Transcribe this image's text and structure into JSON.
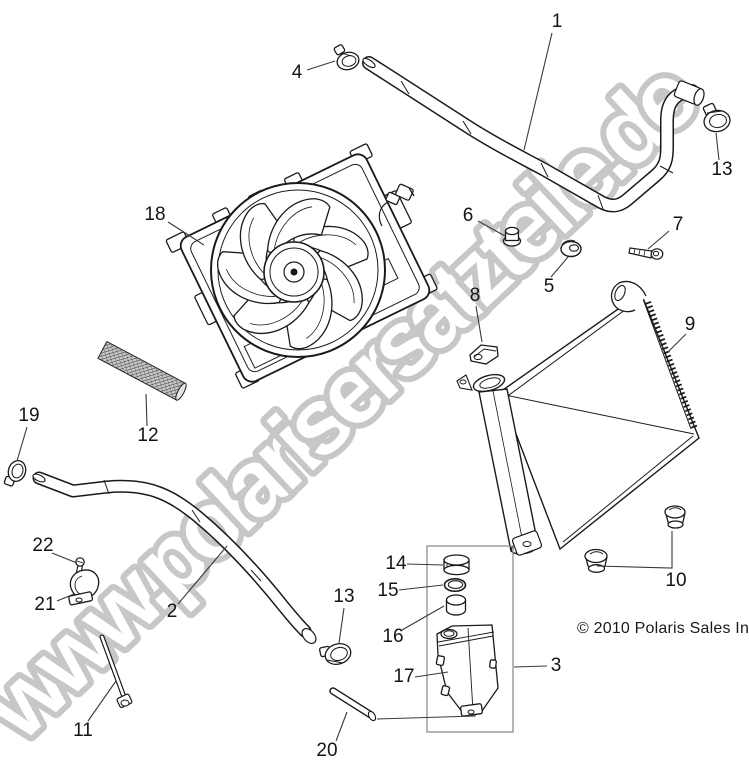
{
  "watermark": {
    "text": "www.polarisersatzteile.de",
    "fill": "#ffffff",
    "stroke": "#c7c7c7"
  },
  "copyright": "© 2010 Polaris Sales Inc.",
  "ink": "#1a1a1a",
  "leader_color": "#3a3a3a",
  "callouts": [
    {
      "n": "1",
      "x": 557,
      "y": 22,
      "leader": [
        552,
        33,
        524,
        150
      ]
    },
    {
      "n": "4",
      "x": 297,
      "y": 73,
      "leader": [
        307,
        70,
        335,
        61
      ]
    },
    {
      "n": "13",
      "x": 722,
      "y": 170,
      "leader": [
        719,
        160,
        716,
        133
      ]
    },
    {
      "n": "18",
      "x": 155,
      "y": 215,
      "leader": [
        168,
        222,
        204,
        245
      ]
    },
    {
      "n": "6",
      "x": 468,
      "y": 216,
      "leader": [
        478,
        221,
        505,
        236
      ]
    },
    {
      "n": "7",
      "x": 678,
      "y": 225,
      "leader": [
        669,
        231,
        648,
        249
      ]
    },
    {
      "n": "5",
      "x": 549,
      "y": 287,
      "leader": [
        551,
        277,
        568,
        257
      ]
    },
    {
      "n": "8",
      "x": 475,
      "y": 296,
      "leader": [
        476,
        306,
        482,
        342
      ]
    },
    {
      "n": "9",
      "x": 690,
      "y": 325,
      "leader": [
        686,
        334,
        668,
        352
      ]
    },
    {
      "n": "19",
      "x": 29,
      "y": 416,
      "leader": [
        27,
        427,
        17,
        461
      ]
    },
    {
      "n": "12",
      "x": 148,
      "y": 436,
      "leader": [
        147,
        426,
        146,
        394
      ]
    },
    {
      "n": "22",
      "x": 43,
      "y": 546,
      "leader": [
        52,
        553,
        77,
        563
      ]
    },
    {
      "n": "14",
      "x": 396,
      "y": 564,
      "leader": [
        407,
        564,
        443,
        565
      ]
    },
    {
      "n": "15",
      "x": 388,
      "y": 591,
      "leader": [
        399,
        590,
        443,
        585
      ]
    },
    {
      "n": "21",
      "x": 45,
      "y": 605,
      "leader": [
        57,
        601,
        74,
        594
      ]
    },
    {
      "n": "13",
      "x": 344,
      "y": 597,
      "leader": [
        344,
        608,
        339,
        643
      ]
    },
    {
      "n": "2",
      "x": 172,
      "y": 612,
      "leader": [
        178,
        604,
        227,
        546
      ]
    },
    {
      "n": "16",
      "x": 393,
      "y": 637,
      "leader": [
        402,
        630,
        444,
        606
      ]
    },
    {
      "n": "17",
      "x": 404,
      "y": 677,
      "leader": [
        415,
        677,
        448,
        672
      ]
    },
    {
      "n": "3",
      "x": 556,
      "y": 666,
      "leader": [
        547,
        666,
        514,
        667
      ]
    },
    {
      "n": "10",
      "x": 676,
      "y": 581,
      "leader": null
    },
    {
      "n": "11",
      "x": 83,
      "y": 731,
      "leader": [
        88,
        721,
        116,
        681
      ]
    },
    {
      "n": "20",
      "x": 327,
      "y": 751,
      "leader": [
        336,
        741,
        347,
        712
      ]
    }
  ],
  "extra_leader_lines": [
    [
      597,
      566,
      672,
      568,
      672,
      531
    ],
    [
      377,
      719,
      476,
      716
    ]
  ]
}
